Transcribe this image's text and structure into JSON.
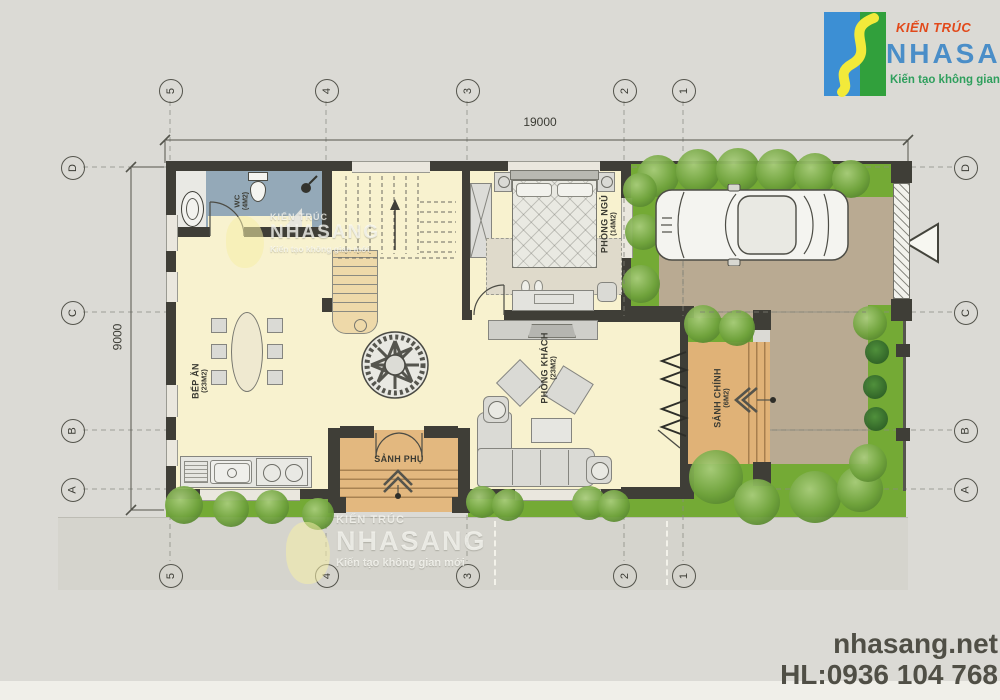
{
  "logo": {
    "kicker": "KIẾN TRÚC",
    "brand": "NHASANG",
    "tagline": "Kiến tạo không gian mới"
  },
  "footer": {
    "website": "nhasang.net",
    "hotline": "HL:0936 104 768"
  },
  "watermark": {
    "kicker": "KIẾN TRÚC",
    "brand": "NHASANG",
    "tagline": "Kiến tạo không gian mới"
  },
  "plan": {
    "dim_width": "19000",
    "dim_height": "9000",
    "grid_cols": [
      "5",
      "4",
      "3",
      "2",
      "1"
    ],
    "grid_rows": [
      "D",
      "C",
      "B",
      "A"
    ],
    "rooms": {
      "wc": {
        "name": "WC",
        "area": "(4M2)"
      },
      "kitchen": {
        "name": "BẾP ĂN",
        "area": "(23M2)"
      },
      "bedroom": {
        "name": "PHÒNG NGỦ",
        "area": "(14M2)"
      },
      "living": {
        "name": "PHÒNG KHÁCH",
        "area": "(23M2)"
      },
      "main_hall": {
        "name": "SẢNH CHÍNH",
        "area": "(6M2)"
      },
      "side_hall": {
        "name": "SẢNH PHỤ"
      }
    }
  },
  "colors": {
    "page_bg": "#dbdad5",
    "floor_cream": "#f8f2cf",
    "bath_blue": "#94a9b8",
    "porch_tan": "#e0b277",
    "driveway_tan": "#b9aa92",
    "grass_green": "#74aa35",
    "wall_dark": "#3f3e37",
    "logo_blue": "#3c8fd4",
    "logo_green": "#31a03c",
    "logo_yellow": "#f2ea3a",
    "brand_red": "#e2491a",
    "brand_blue": "#4a8ec8",
    "footer_text": "#504f46"
  }
}
